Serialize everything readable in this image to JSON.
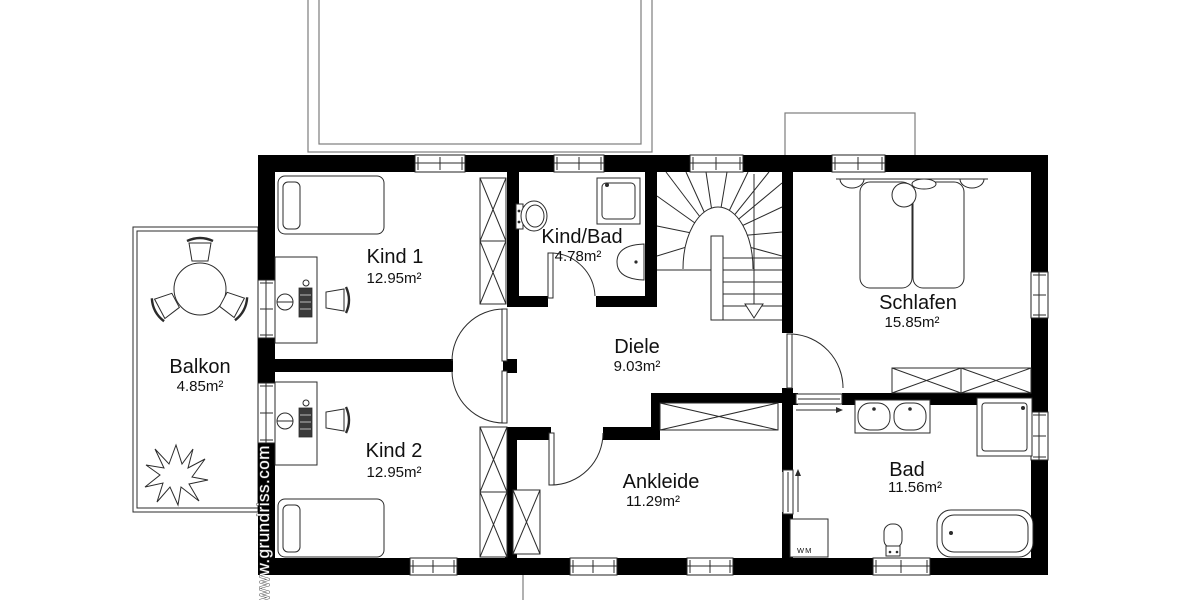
{
  "watermark": "www.grundriss.com",
  "rooms": {
    "kind1": {
      "name": "Kind 1",
      "area": "12.95m²"
    },
    "kindbad": {
      "name": "Kind/Bad",
      "area": "4.78m²"
    },
    "schlafen": {
      "name": "Schlafen",
      "area": "15.85m²"
    },
    "diele": {
      "name": "Diele",
      "area": "9.03m²"
    },
    "kind2": {
      "name": "Kind 2",
      "area": "12.95m²"
    },
    "ankleide": {
      "name": "Ankleide",
      "area": "11.29m²"
    },
    "bad": {
      "name": "Bad",
      "area": "11.56m²"
    },
    "balkon": {
      "name": "Balkon",
      "area": "4.85m²"
    }
  },
  "labels": {
    "washing_machine": "WM"
  },
  "colors": {
    "wall": "#000000",
    "line": "#2b2b2b",
    "muted_line": "#7d7d7d",
    "text": "#111111",
    "background": "#ffffff"
  }
}
